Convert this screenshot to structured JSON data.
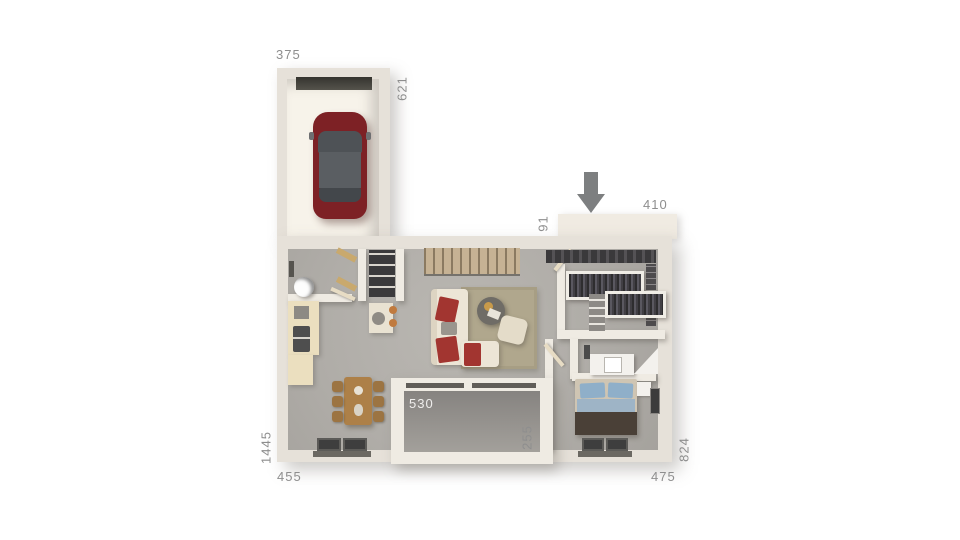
{
  "dimensions": {
    "garage_width": "375",
    "garage_depth": "621",
    "entry_recess": "91",
    "entry_width": "410",
    "terrace_width": "530",
    "terrace_depth": "255",
    "house_side_left": "1445",
    "house_bottom_left": "455",
    "house_bottom_right": "475",
    "house_side_right": "824"
  },
  "icons": {
    "entrance_arrow": "arrow-down"
  },
  "colors": {
    "wall": "#e6e1d9",
    "floor": "#b2afab",
    "garage_floor": "#f7f3ea",
    "terrace_floor": "#9c9894",
    "car_red": "#7d2125",
    "bed_blue": "#8fafc9",
    "wood": "#ad8048",
    "label_gray": "#8e8e8e",
    "arrow_gray": "#7d7f80"
  }
}
